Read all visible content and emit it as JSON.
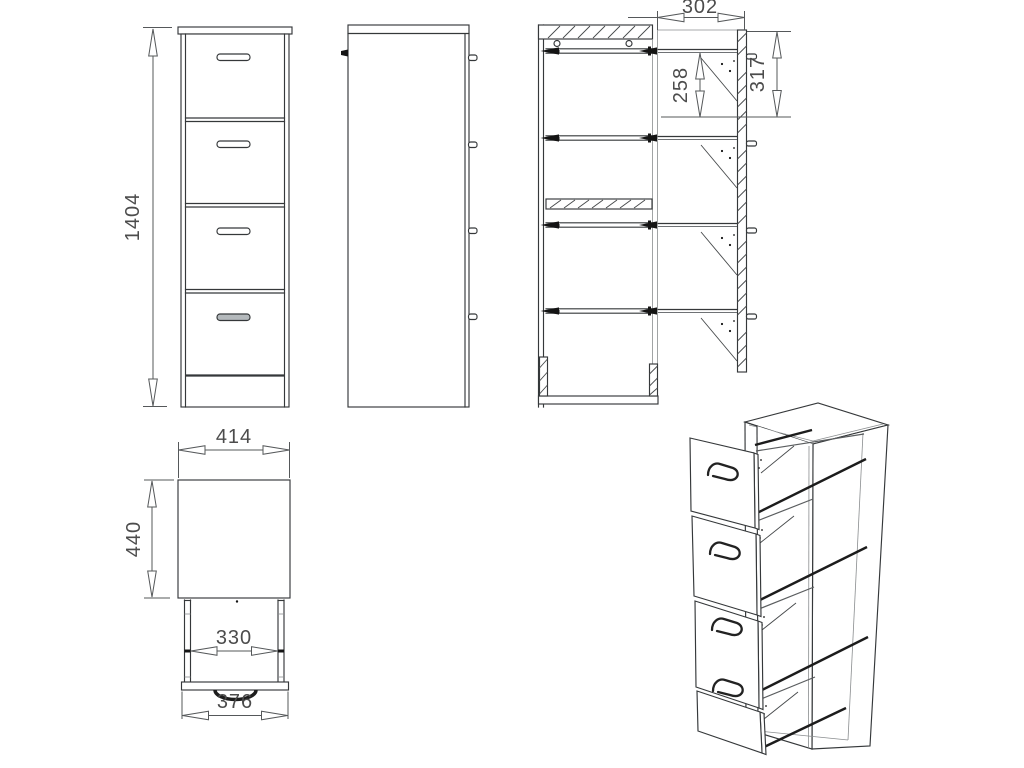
{
  "dimensions": {
    "overall_height": "1404",
    "top_rail_depth": "302",
    "hanging_file_height": "258",
    "top_interior_height": "317",
    "overall_width": "414",
    "overall_depth": "440",
    "drawer_inner_width": "330",
    "drawer_front_width": "376"
  },
  "colors": {
    "line": "#35383a",
    "dimension_text": "#4c4c4c",
    "rail": "#1c1c1c",
    "handle_fill_bottom": "#b4b9bc",
    "background": "#ffffff"
  }
}
